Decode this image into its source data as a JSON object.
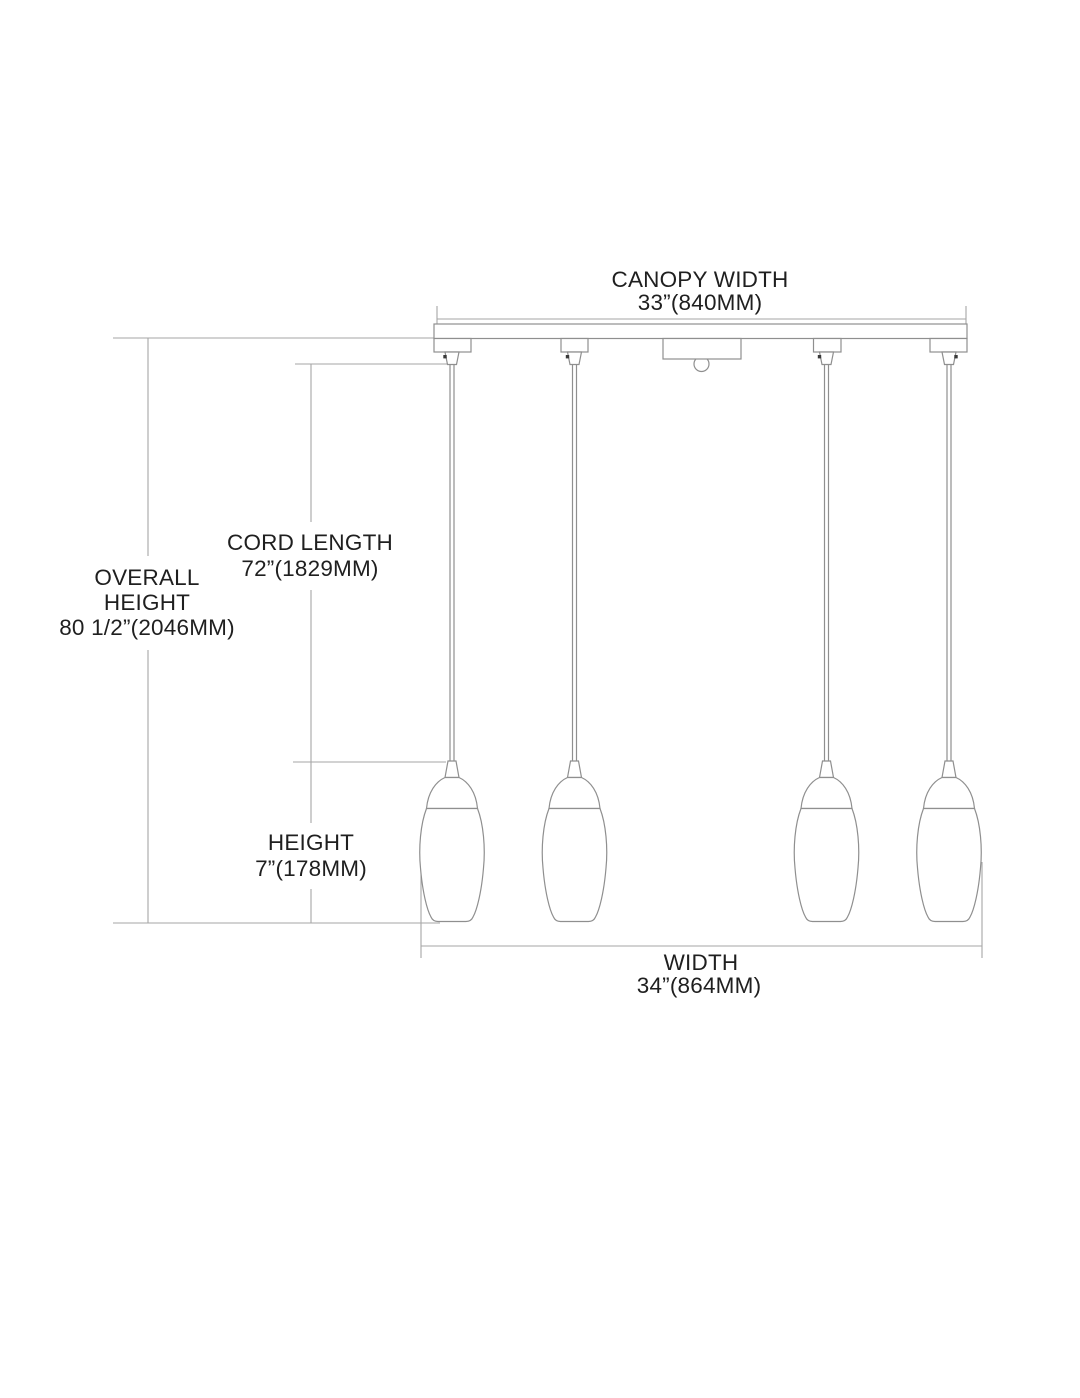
{
  "diagram": {
    "pendant_count": 4,
    "labels": {
      "canopy_width": {
        "title": "CANOPY WIDTH",
        "value": "33”(840MM)"
      },
      "overall_height": {
        "title_line1": "OVERALL",
        "title_line2": "HEIGHT",
        "value": "80 1/2”(2046MM)"
      },
      "cord_length": {
        "title": "CORD LENGTH",
        "value": "72”(1829MM)"
      },
      "height": {
        "title": "HEIGHT",
        "value": "7”(178MM)"
      },
      "width": {
        "title": "WIDTH",
        "value": "34”(864MM)"
      }
    },
    "colors": {
      "background": "#ffffff",
      "fixture_line": "#8f8f8f",
      "dimension_line": "#a6a6a6",
      "text": "#1f1f1f"
    }
  }
}
